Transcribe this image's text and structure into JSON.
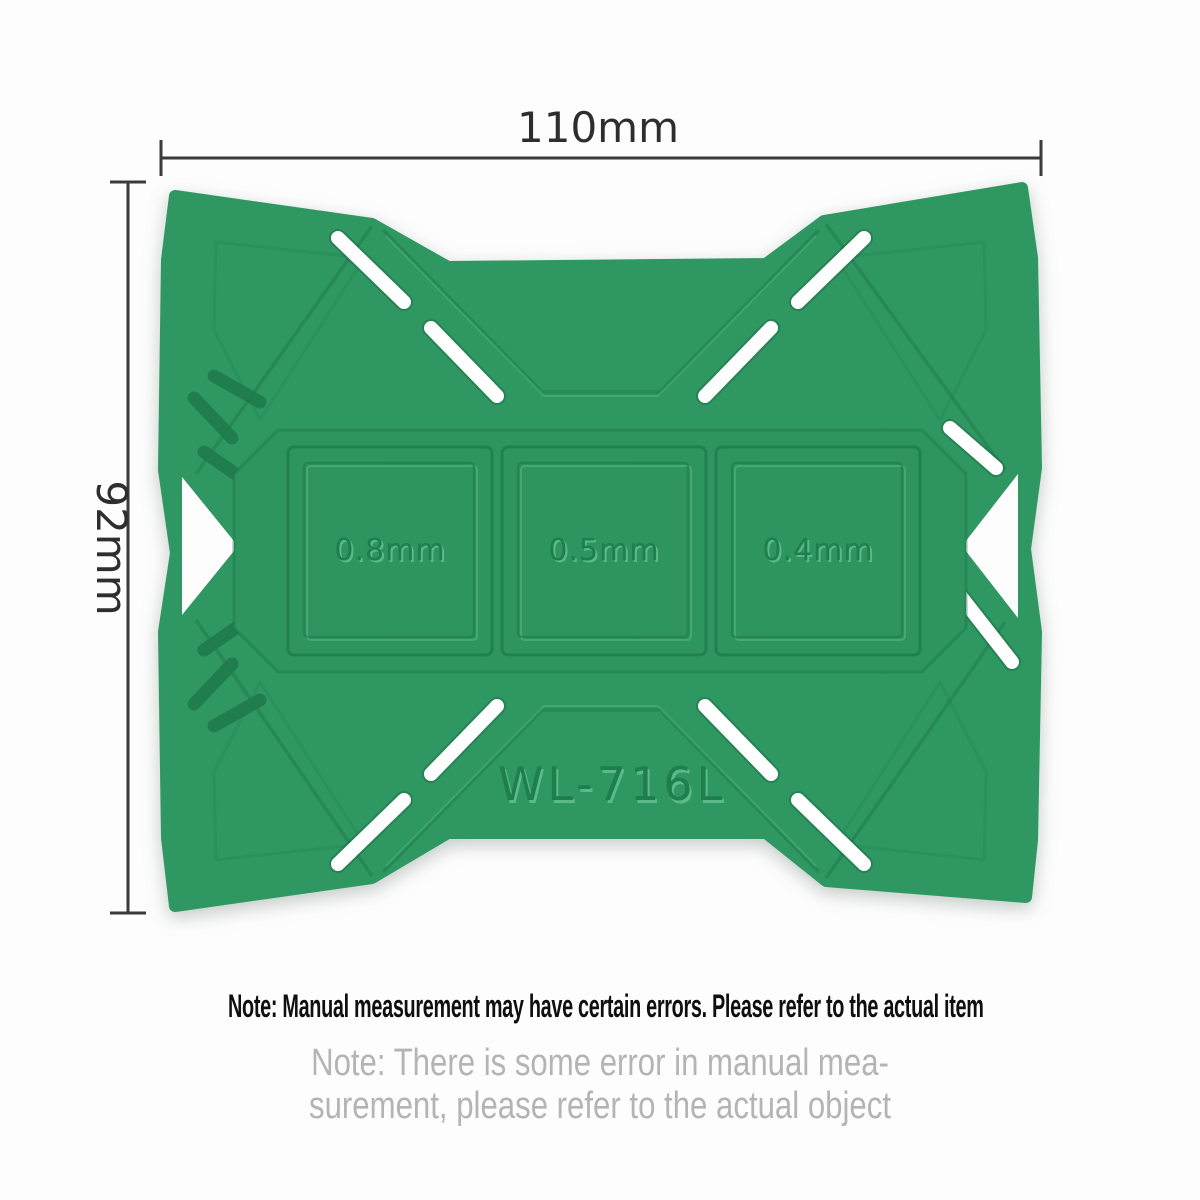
{
  "diagram": {
    "width_label": "110mm",
    "height_label": "92mm",
    "model_label": "WL-716L",
    "thickness_slots": [
      {
        "label": "0.8mm"
      },
      {
        "label": "0.5mm"
      },
      {
        "label": "0.4mm"
      }
    ],
    "colors": {
      "pad_green": "#2f9862",
      "groove_green": "#1e7a4a",
      "slot_white": "#ffffff",
      "dimension_line": "#3a3a3a",
      "note_primary": "#0f0f0f",
      "note_secondary": "#b4b4b4",
      "background": "#fdfdfd"
    }
  },
  "notes": {
    "primary": "Note: Manual measurement may have certain errors. Please refer to the actual item",
    "secondary_line1": "Note: There is some error in manual mea-",
    "secondary_line2": "surement, please refer to the actual object"
  }
}
